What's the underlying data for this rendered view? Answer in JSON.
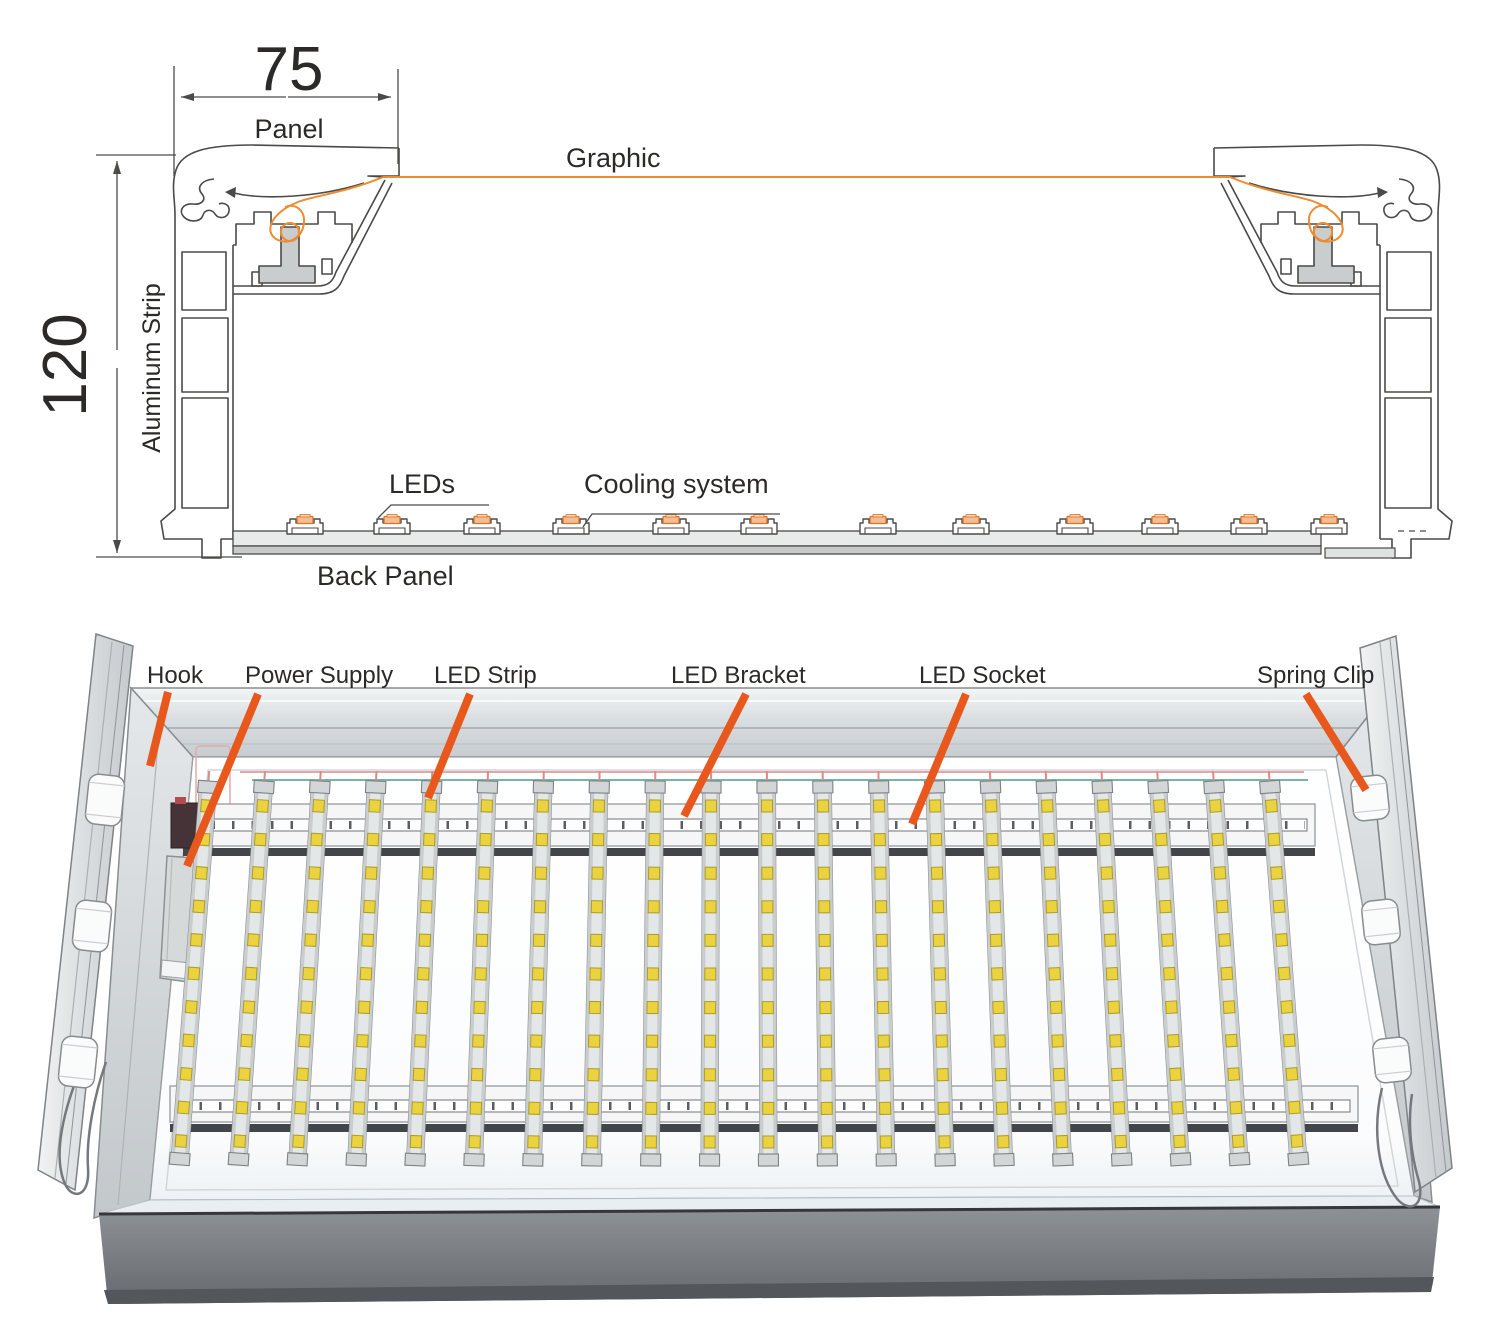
{
  "title": "LED light box structure diagram",
  "colors": {
    "outline": "#4a4a48",
    "text": "#2b2a28",
    "accent": "#e8581c",
    "graphic_line": "#ef8a2e",
    "chip_fill": "#f6bd92",
    "chip_top": "#fbd9b8",
    "chip_edge": "#d9722b",
    "led_yellow": "#ead33f",
    "led_edge": "#ab9b2a",
    "wire_red": "#d98b8b",
    "wire_teal": "#7cb3a5"
  },
  "cross_section": {
    "width_value": "75",
    "width_label": "Panel",
    "height_value": "120",
    "height_label": "Aluminum Strip",
    "graphic_label": "Graphic",
    "leds_label": "LEDs",
    "cooling_label": "Cooling system",
    "back_panel_label": "Back Panel",
    "led_module_positions": [
      305,
      392,
      482,
      571,
      671,
      759,
      878,
      971,
      1075,
      1160,
      1249,
      1329
    ]
  },
  "illustration": {
    "callouts": [
      {
        "id": "hook",
        "label": "Hook",
        "tx": 147,
        "ty": 683,
        "x1": 168,
        "y1": 692,
        "x2": 150,
        "y2": 766
      },
      {
        "id": "power-supply",
        "label": "Power Supply",
        "tx": 245,
        "ty": 683,
        "x1": 258,
        "y1": 694,
        "x2": 187,
        "y2": 866
      },
      {
        "id": "led-strip",
        "label": "LED Strip",
        "tx": 434,
        "ty": 683,
        "x1": 470,
        "y1": 694,
        "x2": 428,
        "y2": 798
      },
      {
        "id": "led-bracket",
        "label": "LED Bracket",
        "tx": 671,
        "ty": 683,
        "x1": 746,
        "y1": 694,
        "x2": 684,
        "y2": 816
      },
      {
        "id": "led-socket",
        "label": "LED Socket",
        "tx": 919,
        "ty": 683,
        "x1": 966,
        "y1": 694,
        "x2": 912,
        "y2": 824
      },
      {
        "id": "spring-clip",
        "label": "Spring Clip",
        "tx": 1257,
        "ty": 683,
        "x1": 1306,
        "y1": 694,
        "x2": 1366,
        "y2": 790
      }
    ],
    "led_strips": {
      "count": 20,
      "x_start": 208,
      "x_end": 1270,
      "top_y": 787,
      "length": 373,
      "leds_per_strip": 11,
      "led_spacing": 33.6,
      "fan_deg_per_px": 0.0082,
      "center_x": 739
    },
    "hooks": [
      {
        "x": 105,
        "y": 800
      },
      {
        "x": 92,
        "y": 926
      },
      {
        "x": 78,
        "y": 1062
      }
    ],
    "clips": [
      {
        "x": 1370,
        "y": 798
      },
      {
        "x": 1381,
        "y": 922
      },
      {
        "x": 1392,
        "y": 1060
      }
    ]
  }
}
